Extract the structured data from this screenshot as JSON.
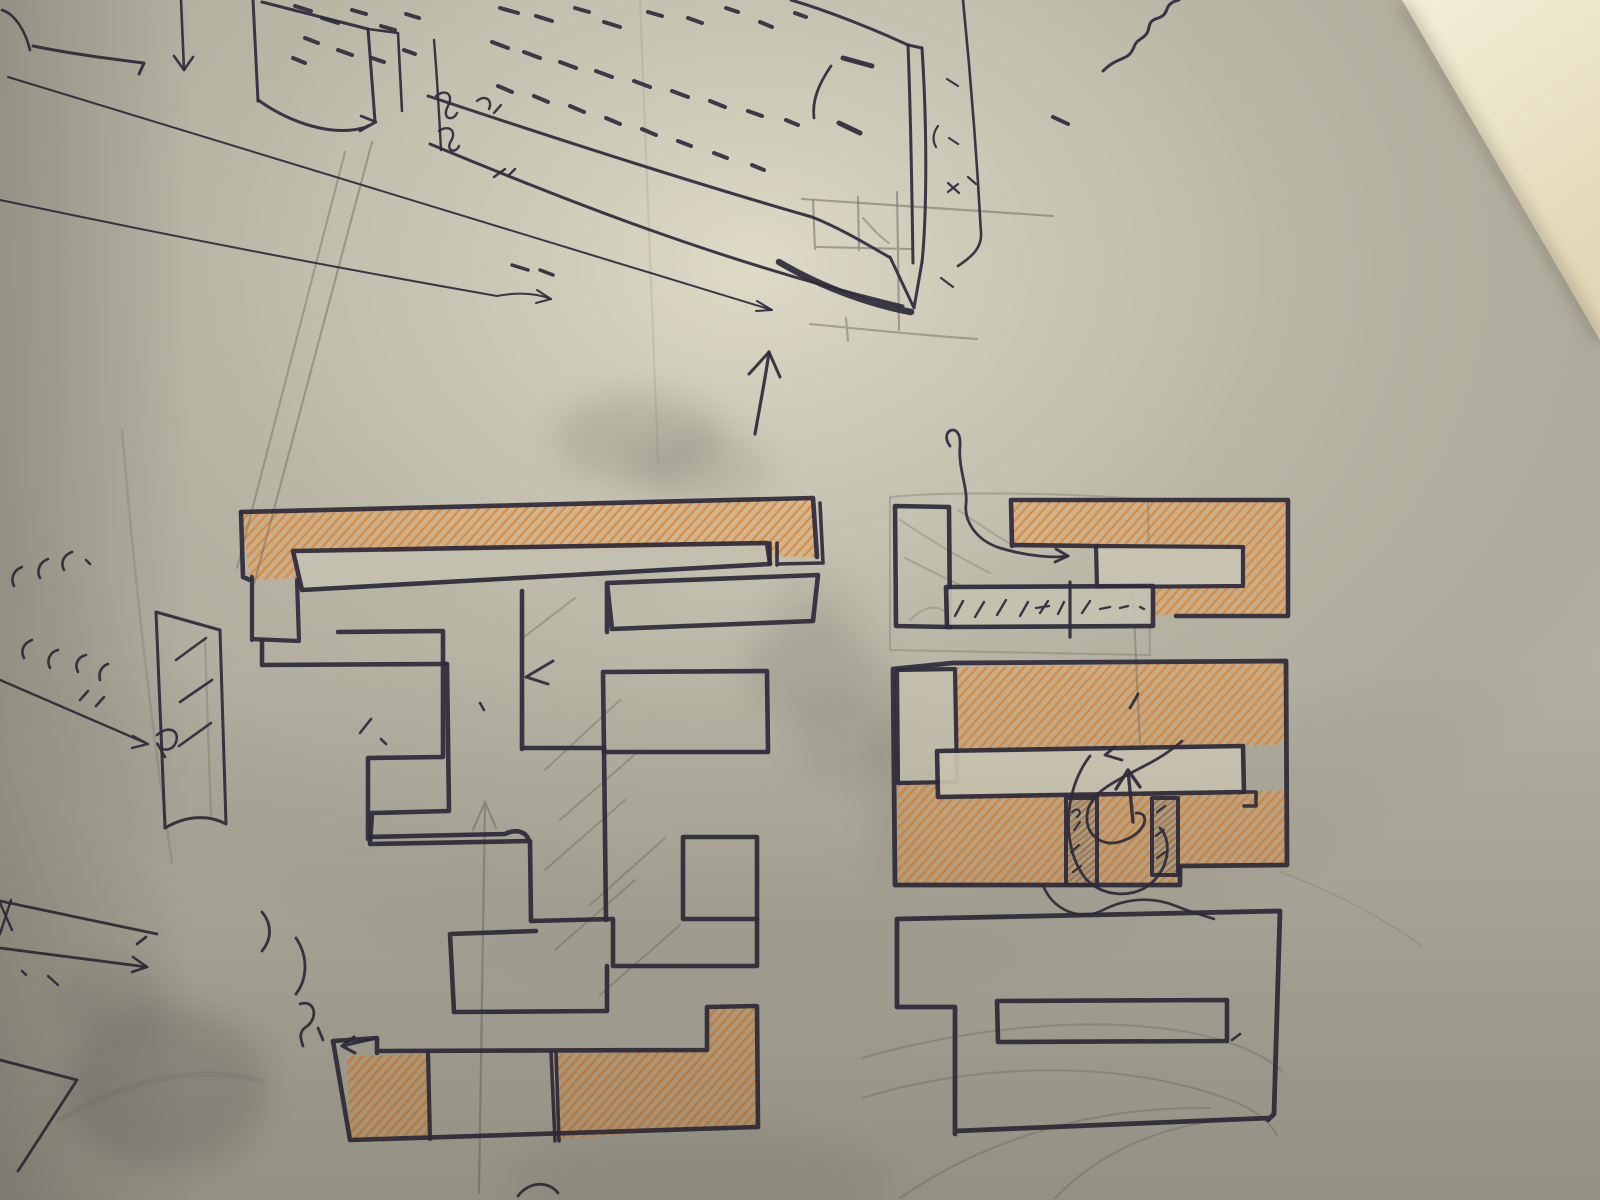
{
  "palette": {
    "paper_base": "#b3b0a1",
    "ink": "#2e2b3c",
    "pencil": "#6f6c64",
    "smudge": "#4e4c45",
    "orange_stroke": "#d8883a",
    "orange_light": "#e8a45c",
    "fills": {
      "bar": "#c4c1b0",
      "notch": "#cac5b2",
      "midbar": "#c6c2b0",
      "col": "#c6c1af",
      "rbar": "#cfc9b5",
      "grayhatch": "url(#grayHatch)"
    }
  },
  "scene": {
    "wall_points": "1402,0 1600,0 1600,340",
    "edge_shadow_d": "M1402,2 L1600,340"
  },
  "orange_regions": [
    {
      "n": "left-plan-top-orange-bar",
      "d": "M241,512 L813,498 L817,557 L297,550 L297,578 L250,580 Z"
    },
    {
      "n": "left-plan-bottom-left-orange-cell",
      "d": "M347,1056 L427,1054 L429,1137 L350,1138 Z"
    },
    {
      "n": "left-plan-bottom-right-orange-cell",
      "d": "M558,1054 L706,1051 L707,1008 L755,1008 L756,1125 L560,1139 Z"
    },
    {
      "n": "right-plan-upper-orange",
      "d": "M1012,501 L1287,501 L1287,615 L1154,615 L1154,588 L1242,588 L1242,548 L1012,546 Z"
    },
    {
      "n": "right-plan-lower-orange-upper-half",
      "d": "M957,667 L1285,662 L1285,744 L1243,746 L957,750 Z"
    },
    {
      "n": "right-plan-lower-orange-lower-half",
      "d": "M898,784 L937,783 L938,797 L1244,792 L1287,790 L1287,864 L1180,865 L1180,884 L897,884 Z"
    }
  ],
  "pen_paths": [
    {
      "n": "corner-curve",
      "d": "M2,10 C12,13 24,26 30,50",
      "w": 2.6
    },
    {
      "n": "top-dash-stroke",
      "d": "M33,46 C72,54 112,59 144,63 L139,74",
      "w": 3
    },
    {
      "n": "drop-line",
      "d": "M181,0 L184,70",
      "w": 2.6
    },
    {
      "n": "drop-line-arrowhead",
      "d": "M184,70 L174,56 M184,70 L193,57",
      "w": 2.6
    },
    {
      "n": "box-left-edge",
      "d": "M253,0 L258,101",
      "w": 3
    },
    {
      "n": "box-top-edge",
      "d": "M262,2 L368,29",
      "w": 3
    },
    {
      "n": "box-right-edge",
      "d": "M368,29 L375,121",
      "w": 3
    },
    {
      "n": "box-far-edge",
      "d": "M368,29 L398,33 M398,33 L402,111",
      "w": 2.6
    },
    {
      "n": "box-bottom-curve",
      "d": "M258,100 C292,124 332,136 363,128",
      "w": 3
    },
    {
      "n": "box-bottom-arrowhead",
      "d": "M363,128 L376,122 M376,122 L361,116 M376,122 L360,131",
      "w": 2.6
    },
    {
      "n": "scribble-vertical",
      "d": "M434,40 C437,75 439,112 441,150",
      "w": 2.4
    },
    {
      "n": "scribble-loop-a",
      "d": "M436,96 C446,88 454,95 448,106 C441,119 453,122 457,113",
      "w": 2.4
    },
    {
      "n": "scribble-loop-b",
      "d": "M439,131 C449,124 457,131 451,141 C445,151 456,154 459,146",
      "w": 2.4
    },
    {
      "n": "scribble-loop-c",
      "d": "M477,101 C485,94 493,100 489,109 M494,113 L501,105",
      "w": 2.4
    },
    {
      "n": "long-line-upper",
      "d": "M8,77 C300,165 560,245 772,310",
      "w": 2
    },
    {
      "n": "long-line-upper-arrowhead",
      "d": "M772,310 L757,301 M772,310 L756,311",
      "w": 2
    },
    {
      "n": "long-line-lower",
      "d": "M0,200 C180,238 360,272 497,296 C518,292 536,293 551,299",
      "w": 2
    },
    {
      "n": "long-line-lower-arrowhead",
      "d": "M551,299 L537,290 M551,299 L536,303",
      "w": 2
    },
    {
      "n": "slab-front-top-edge",
      "d": "M428,96 C560,140 700,185 812,217 C840,228 868,245 889,257",
      "w": 3
    },
    {
      "n": "slab-back-corner-edge",
      "d": "M791,0 C832,12 880,32 908,45",
      "w": 3
    },
    {
      "n": "slab-end-left-edge",
      "d": "M908,45 C911,120 912,200 913,263",
      "w": 3
    },
    {
      "n": "slab-end-top-edge",
      "d": "M908,45 L922,48",
      "w": 3
    },
    {
      "n": "slab-end-right-edge",
      "d": "M922,48 C928,140 926,225 922,262",
      "w": 3
    },
    {
      "n": "slab-end-bottom-v",
      "d": "M922,262 L914,308 M914,308 L890,257",
      "w": 3
    },
    {
      "n": "slab-bottom-heavy-edge",
      "d": "M779,262 C828,291 878,306 911,312",
      "w": 6.5
    },
    {
      "n": "slab-front-bottom-edge",
      "d": "M430,144 C560,198 720,262 903,306",
      "w": 3
    },
    {
      "n": "slab-right-cut-line",
      "d": "M963,0 C971,80 977,160 981,233 C982,247 973,256 958,266",
      "w": 2.6
    },
    {
      "n": "end-face-inner-curve",
      "d": "M831,66 C818,85 812,101 814,118",
      "w": 2.8
    },
    {
      "n": "thick-dash-a",
      "d": "M843,58 L872,66",
      "w": 5
    },
    {
      "n": "thick-dash-b",
      "d": "M839,123 L860,133",
      "w": 5
    },
    {
      "n": "right-margin-ticks",
      "d": "M947,79 L958,86 M949,138 L958,144 M938,126 C933,133 932,140 936,147 M948,183 L959,193 M958,184 L948,192 M941,278 L953,287 M968,177 L976,184",
      "w": 2.2
    },
    {
      "n": "under-slab-ticks",
      "d": "M494,177 L505,169 M509,175 L515,169",
      "w": 2.4
    },
    {
      "n": "under-slab-dashes",
      "d": "M512,265 L528,270 M540,270 L553,275",
      "w": 3.5
    },
    {
      "n": "center-up-arrow",
      "d": "M755,434 C760,405 766,375 769,352",
      "w": 3.2
    },
    {
      "n": "center-up-arrowhead",
      "d": "M769,352 L749,374 M769,352 L780,377",
      "w": 3
    },
    {
      "n": "top-right-squiggle",
      "d": "M1103,71 C1119,55 1128,62 1134,47 C1137,37 1147,40 1149,27 C1151,15 1163,22 1167,9 C1169,3 1174,1 1179,0",
      "w": 3
    },
    {
      "n": "top-right-dash",
      "d": "M1053,117 L1068,124",
      "w": 4
    },
    {
      "n": "left-plan-orange-outline",
      "d": "M241,512 L813,498 L817,557",
      "w": 4.6
    },
    {
      "n": "left-plan-orange-left-edge",
      "d": "M241,512 L243,577 L250,580",
      "w": 4.6
    },
    {
      "n": "left-plan-white-bar",
      "d": "M293,551 L767,543 L770,564 L302,590 Z",
      "w": 4.6,
      "f": "bar"
    },
    {
      "n": "left-plan-connector",
      "d": "M770,543 L770,564 M777,543 L777,565 M777,564 L822,563 M820,503 L823,563",
      "w": 3.6
    },
    {
      "n": "left-plan-corner-square",
      "d": "M252,577 L252,640 M252,639 L298,641 M297,580 L299,641",
      "w": 4.2
    },
    {
      "n": "left-plan-band-bottom",
      "d": "M262,641 L262,665 L447,664",
      "w": 4.6
    },
    {
      "n": "left-plan-stair-walls",
      "d": "M447,664 L449,811 L372,813 L370,844 L530,841 L531,921 L613,919 L613,966 L757,966 L757,919",
      "w": 4.6
    },
    {
      "n": "left-plan-corridor",
      "d": "M338,632 L443,631 L443,757 L368,758 L368,839 M368,837 L505,834 C515,829 524,831 528,838",
      "w": 4.6
    },
    {
      "n": "left-plan-t-stem",
      "d": "M522,591 L522,749 M522,748 L604,748 M604,748 L606,920",
      "w": 4.6
    },
    {
      "n": "left-plan-wide-bar",
      "d": "M607,583 L818,575 L813,621 L612,629 L607,583 M607,583 L607,632",
      "w": 4.6
    },
    {
      "n": "left-plan-mid-rect",
      "d": "M603,672 L767,671 L768,752 L604,752 Z",
      "w": 4.6
    },
    {
      "n": "left-plan-small-square",
      "d": "M683,837 L757,837 L757,919 L683,919 Z",
      "w": 4.6
    },
    {
      "n": "left-plan-mid-room",
      "d": "M450,934 L536,931 M450,934 L454,1012 L607,1011 L607,966",
      "w": 4.6
    },
    {
      "n": "left-plan-bottom-strip",
      "d": "M333,1041 L377,1038 L377,1053 M377,1051 L707,1050 M707,1050 L707,1007 L757,1006 L758,1127 M758,1127 L350,1140 L333,1041",
      "w": 4.6
    },
    {
      "n": "left-plan-strip-divider-1",
      "d": "M428,1052 L430,1139",
      "w": 4.2
    },
    {
      "n": "left-plan-strip-divider-2",
      "d": "M551,1052 L555,1141 M556,1052 L559,1141",
      "w": 3.6
    },
    {
      "n": "left-plan-strip-arrow",
      "d": "M377,1038 L342,1046 M342,1046 L354,1037 M342,1046 L355,1053",
      "w": 3
    },
    {
      "n": "left-plan-small-ticks",
      "d": "M360,733 L371,719 M381,739 L386,744 M480,703 L484,710",
      "w": 2.6
    },
    {
      "n": "left-plan-arrow-mark",
      "d": "M553,661 L526,677 M526,677 L548,684",
      "w": 3
    },
    {
      "n": "right-plan-left-rect",
      "d": "M895,506 L949,507 L950,627 L896,626 Z",
      "w": 4.6
    },
    {
      "n": "right-plan-orange-outline",
      "d": "M1011,500 L1288,500 L1288,616 M1011,500 L1012,546 M1012,545 L1096,546 M1176,616 L1288,616",
      "w": 4.6
    },
    {
      "n": "right-plan-notch-rect",
      "d": "M1096,546 L1243,547 L1243,586 L1097,587 Z",
      "w": 4.2,
      "f": "notch"
    },
    {
      "n": "right-plan-mid-bar",
      "d": "M946,587 L1153,586 L1153,626 L947,627 Z",
      "w": 4.6,
      "f": "midbar"
    },
    {
      "n": "right-plan-mid-bar-vertical",
      "d": "M1070,582 L1070,637",
      "w": 3.2
    },
    {
      "n": "right-plan-mid-bar-marks",
      "d": "M955,616 L963,601 M975,617 L984,602 M997,615 L1006,600 M1020,616 L1028,602 M1040,613 L1048,601 M1036,608 L1049,606 M1058,614 L1064,602 M1082,613 L1090,601 M1100,609 L1110,607 M1120,608 L1128,606 M1140,607 L1144,609",
      "w": 2.4
    },
    {
      "n": "right-plan-squiggle",
      "d": "M950,446 C938,430 962,420 960,446 C958,468 968,488 966,504 C964,520 975,540 1000,548 C1030,557 1056,558 1068,556",
      "w": 2.8
    },
    {
      "n": "right-plan-squiggle-arrowhead",
      "d": "M1068,556 L1056,549 M1068,556 L1055,562",
      "w": 2.8
    },
    {
      "n": "right-plan-lower-outline",
      "d": "M893,669 L953,663 L1286,661 M1286,661 L1287,865 L1180,866 L1180,885 L895,885 L893,669",
      "w": 4.8
    },
    {
      "n": "right-plan-left-column",
      "d": "M897,670 L955,669 L957,782 L898,783 Z",
      "w": 4.2,
      "f": "col"
    },
    {
      "n": "right-plan-lower-white-bar",
      "d": "M937,751 L1243,746 L1244,792 L938,797 Z",
      "w": 4.6,
      "f": "rbar"
    },
    {
      "n": "right-plan-bar-step",
      "d": "M1243,792 L1256,792 L1256,806 L1244,806",
      "w": 3.6
    },
    {
      "n": "right-plan-door-a",
      "d": "M1066,798 L1097,798 L1097,885 L1066,885 Z",
      "w": 4,
      "f": "grayhatch"
    },
    {
      "n": "right-plan-door-b",
      "d": "M1152,798 L1178,798 L1178,875 L1152,875 Z",
      "w": 4,
      "f": "grayhatch"
    },
    {
      "n": "right-plan-up-arrow",
      "d": "M1133,822 L1128,770 M1128,770 L1116,789 M1128,770 L1140,787",
      "w": 3.4
    },
    {
      "n": "right-plan-loop-a",
      "d": "M1182,741 C1148,772 1096,780 1088,810 C1082,834 1102,847 1119,842 C1146,835 1152,812 1136,813",
      "w": 2.8
    },
    {
      "n": "right-plan-loop-b",
      "d": "M1090,756 C1062,792 1062,850 1086,879 C1101,896 1131,899 1149,885 C1170,869 1172,840 1160,828",
      "w": 2.8
    },
    {
      "n": "right-plan-arrow-mark",
      "d": "M1122,760 L1105,755 M1105,755 L1115,747",
      "w": 2.8
    },
    {
      "n": "right-plan-meander",
      "d": "M1043,885 C1052,910 1080,921 1101,911 C1126,898 1151,896 1176,906 C1196,914 1209,917 1214,919",
      "w": 2.6
    },
    {
      "n": "right-plan-door-marks",
      "d": "M1072,812 C1078,806 1083,812 1077,817 M1074,830 L1080,822 M1071,852 L1079,845 M1073,872 L1081,866 M1157,812 L1165,806 M1156,836 L1164,830 M1157,858 L1165,852",
      "w": 2.2
    },
    {
      "n": "right-plan-top-tick",
      "d": "M1130,708 L1138,694",
      "w": 2.8
    },
    {
      "n": "bottom-right-plan-outline",
      "d": "M897,919 L1280,911 M1280,911 L1274,1114 L1268,1120 M955,1131 L1270,1118 M897,919 L897,1007 L955,1007 M955,1007 L955,1134",
      "w": 4.8
    },
    {
      "n": "bottom-right-plan-inner-bar",
      "d": "M997,1001 L1227,1000 L1227,1041 L998,1042 Z",
      "w": 4.6
    },
    {
      "n": "bottom-right-plan-tick",
      "d": "M1232,1040 L1240,1034",
      "w": 2.6
    },
    {
      "n": "bottom-left-thin-bar",
      "d": "M0,901 L157,934 M0,948 L147,967 M137,944 L146,937",
      "w": 2.8
    },
    {
      "n": "bottom-left-bar-arrowhead",
      "d": "M147,967 L133,957 M147,967 L132,972",
      "w": 2.6
    },
    {
      "n": "bottom-left-x-mark",
      "d": "M0,903 L12,930 M11,900 L0,934",
      "w": 2.4
    },
    {
      "n": "bottom-left-dots",
      "d": "M22,971 L26,975 M48,976 L58,985",
      "w": 2.4
    },
    {
      "n": "bottom-left-trapezoid",
      "d": "M0,1060 L77,1080 M77,1080 L18,1171",
      "w": 2.8
    },
    {
      "n": "bottom-left-squiggles",
      "d": "M262,912 C272,924 272,939 262,951 M296,938 C308,956 308,978 296,994 M300,1004 C315,999 319,1018 306,1027 C298,1032 301,1040 303,1046 M318,1028 L323,1040",
      "w": 2.8
    },
    {
      "n": "bottom-center-curl",
      "d": "M518,1196 C528,1182 548,1180 558,1193",
      "w": 2.8
    },
    {
      "n": "left-side-tick-row-1",
      "d": "M14,586 C10,578 14,570 22,567 M40,578 C36,570 40,562 48,559 M64,570 C60,562 64,555 72,552 M86,560 L90,564",
      "w": 2.6
    },
    {
      "n": "left-side-tick-row-2",
      "d": "M24,658 C20,650 24,643 32,640 M50,668 C46,660 50,652 58,650 M78,672 C74,664 78,657 86,655 M100,680 C98,672 102,666 108,664 M80,700 L88,691 M96,706 L104,697",
      "w": 2.6
    },
    {
      "n": "left-side-arrow",
      "d": "M0,680 L148,744 M148,744 L133,736 M148,744 L132,748",
      "w": 2.4
    },
    {
      "n": "left-side-curl",
      "d": "M157,735 C168,725 180,730 176,742 C173,751 162,752 158,745 C156,740 160,749 165,757",
      "w": 2.6
    },
    {
      "n": "left-side-tall-bar",
      "d": "M156,612 L220,630 M156,612 L165,828 M220,630 L226,824 M165,828 C185,816 208,814 226,824",
      "w": 3
    },
    {
      "n": "left-side-bar-hatch",
      "d": "M176,660 L206,638 M180,702 L212,680 M179,746 L211,723",
      "w": 2.6
    }
  ],
  "pencil_paths": [
    {
      "n": "projection-line-a",
      "d": "M372,142 L254,584",
      "o": 0.5
    },
    {
      "n": "projection-line-b",
      "d": "M345,152 L237,568",
      "o": 0.45
    },
    {
      "n": "paper-crease-left",
      "d": "M122,430 C138,620 158,770 172,862",
      "o": 0.25,
      "w": 2.5
    },
    {
      "n": "construction-top-line",
      "d": "M802,199 L1053,216",
      "o": 0.55
    },
    {
      "n": "construction-square",
      "d": "M817,247 L913,249 M813,200 L815,249 M858,197 L859,250 M897,192 L898,253 M898,253 L899,330",
      "o": 0.55
    },
    {
      "n": "construction-diagonal",
      "d": "M863,218 C872,228 881,238 889,243",
      "o": 0.45
    },
    {
      "n": "construction-baseline",
      "d": "M810,324 C870,330 930,336 977,339 M846,318 L848,341",
      "o": 0.5
    },
    {
      "n": "left-plan-pencil-diagonals",
      "d": "M545,770 L620,700 M560,820 L640,750 M545,870 L625,800 M590,905 L665,838 M555,950 L635,880 M600,995 L680,925 M520,640 L575,598",
      "o": 0.4
    },
    {
      "n": "left-plan-pencil-up-arrow",
      "d": "M479,1193 L485,802 M485,802 L473,830 M485,802 L496,828",
      "o": 0.5,
      "w": 2.2
    },
    {
      "n": "right-plan-ghost-rect",
      "d": "M890,497 C950,491 1080,493 1148,500 M890,497 L890,650 M890,650 L1150,655 M1148,500 L1150,655",
      "o": 0.35
    },
    {
      "n": "right-plan-ghost-scribbles",
      "d": "M900,520 C930,540 960,558 990,573 M905,558 C935,573 965,588 992,600 M910,620 C928,602 944,606 948,617 M958,510 C980,525 1000,538 1012,545",
      "o": 0.3
    },
    {
      "n": "right-plan-pencil-vertical",
      "d": "M1133,592 C1135,640 1138,700 1140,744 M1133,592 L1126,610",
      "o": 0.45
    },
    {
      "n": "bottom-right-pencil-arcs",
      "d": "M862,1058 C960,1030 1070,1018 1160,1028 C1220,1035 1262,1052 1283,1072 M862,1098 C980,1062 1120,1060 1225,1098 C1258,1110 1272,1124 1277,1136 M900,1198 C990,1136 1100,1106 1210,1108 M1055,1198 C1100,1152 1158,1126 1235,1118",
      "o": 0.35
    },
    {
      "n": "bottom-right-pencil-ext",
      "d": "M1280,872 C1330,890 1380,916 1422,946",
      "o": 0.2
    },
    {
      "n": "paper-crease-center",
      "d": "M640,0 C648,180 654,340 658,462",
      "o": 0.15
    },
    {
      "n": "bottom-left-streak",
      "d": "M60,1120 C120,1082 200,1062 262,1082",
      "o": 0.15,
      "w": 6
    },
    {
      "n": "tall-bar-inner-line",
      "d": "M205,640 L211,818",
      "o": 0.35
    }
  ],
  "dashes": [
    [
      295,
      6,
      311,
      11
    ],
    [
      322,
      18,
      338,
      23
    ],
    [
      352,
      10,
      366,
      14
    ],
    [
      381,
      26,
      395,
      30
    ],
    [
      406,
      14,
      419,
      18
    ],
    [
      305,
      38,
      318,
      43
    ],
    [
      338,
      50,
      352,
      55
    ],
    [
      372,
      58,
      384,
      62
    ],
    [
      404,
      50,
      415,
      54
    ],
    [
      293,
      58,
      305,
      63
    ],
    [
      500,
      8,
      518,
      13
    ],
    [
      536,
      16,
      552,
      21
    ],
    [
      575,
      8,
      589,
      12
    ],
    [
      604,
      22,
      620,
      27
    ],
    [
      648,
      12,
      662,
      16
    ],
    [
      688,
      18,
      702,
      23
    ],
    [
      726,
      8,
      738,
      12
    ],
    [
      760,
      22,
      772,
      27
    ],
    [
      795,
      13,
      806,
      17
    ],
    [
      492,
      42,
      508,
      48
    ],
    [
      524,
      52,
      540,
      58
    ],
    [
      560,
      62,
      576,
      68
    ],
    [
      596,
      71,
      612,
      77
    ],
    [
      634,
      81,
      650,
      87
    ],
    [
      672,
      91,
      688,
      97
    ],
    [
      710,
      101,
      725,
      107
    ],
    [
      748,
      111,
      762,
      116
    ],
    [
      786,
      120,
      798,
      125
    ],
    [
      498,
      86,
      512,
      92
    ],
    [
      534,
      96,
      548,
      102
    ],
    [
      570,
      106,
      584,
      112
    ],
    [
      606,
      118,
      620,
      124
    ],
    [
      642,
      129,
      656,
      135
    ],
    [
      678,
      141,
      691,
      146
    ],
    [
      714,
      153,
      727,
      158
    ],
    [
      752,
      165,
      764,
      170
    ]
  ],
  "smudges": [
    [
      640,
      438,
      85,
      45,
      0.17
    ],
    [
      700,
      468,
      70,
      36,
      0.12
    ],
    [
      812,
      668,
      66,
      54,
      0.14
    ],
    [
      846,
      742,
      54,
      44,
      0.11
    ],
    [
      815,
      600,
      40,
      30,
      0.08
    ],
    [
      168,
      1088,
      100,
      82,
      0.22
    ],
    [
      112,
      1002,
      58,
      40,
      0.13
    ],
    [
      893,
      778,
      24,
      105,
      0.1
    ],
    [
      700,
      1180,
      190,
      55,
      0.09
    ],
    [
      420,
      560,
      35,
      20,
      0.06
    ],
    [
      622,
      562,
      46,
      26,
      0.08
    ]
  ]
}
